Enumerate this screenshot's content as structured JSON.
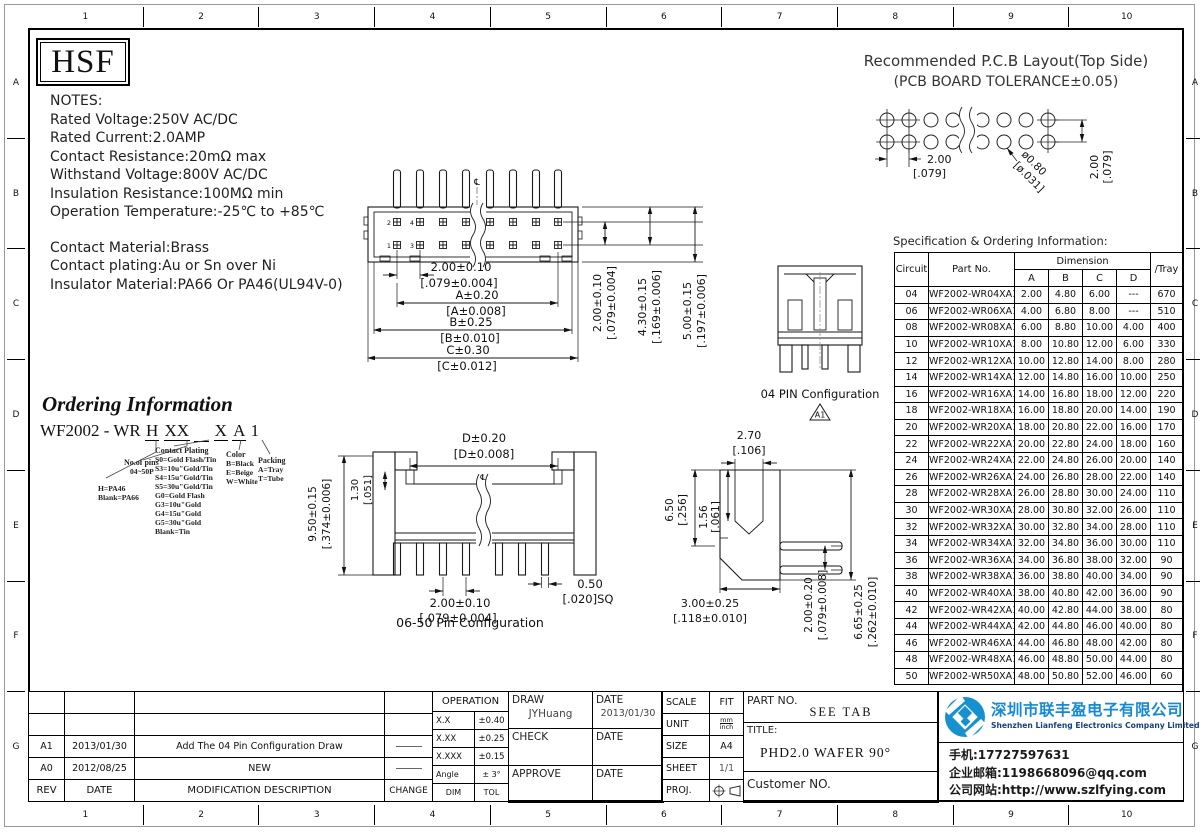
{
  "zones": {
    "cols": [
      "1",
      "2",
      "3",
      "4",
      "5",
      "6",
      "7",
      "8",
      "9",
      "10"
    ],
    "rows": [
      "A",
      "B",
      "C",
      "D",
      "E",
      "F",
      "G"
    ]
  },
  "logo_text": "HSF",
  "notes": {
    "title": "NOTES:",
    "lines": [
      "Rated Voltage:250V AC/DC",
      "Rated Current:2.0AMP",
      "Contact Resistance:20mΩ max",
      "Withstand Voltage:800V AC/DC",
      "Insulation Resistance:100MΩ min",
      "Operation Temperature:-25℃ to +85℃"
    ],
    "material": [
      "Contact Material:Brass",
      "Contact plating:Au or Sn over Ni",
      "Insulator Material:PA66 Or PA46(UL94V-0)"
    ]
  },
  "pcb": {
    "title1": "Recommended P.C.B Layout(Top Side)",
    "title2": "(PCB BOARD TOLERANCE±0.05)",
    "pitch_m": "2.00",
    "pitch_i": "[.079]",
    "hole_m": "ø0.80",
    "hole_i": "[ø.031]",
    "row_m": "2.00",
    "row_i": "[.079]"
  },
  "spec": {
    "caption": "Specification & Ordering Information:",
    "h_circuit": "Circuit",
    "h_part": "Part No.",
    "h_dim": "Dimension",
    "h_cols": [
      "A",
      "B",
      "C",
      "D"
    ],
    "h_tray": "/Tray",
    "rows": [
      [
        "04",
        "WF2002-WR04XA1",
        "2.00",
        "4.80",
        "6.00",
        "---",
        "670"
      ],
      [
        "06",
        "WF2002-WR06XA1",
        "4.00",
        "6.80",
        "8.00",
        "---",
        "510"
      ],
      [
        "08",
        "WF2002-WR08XA1",
        "6.00",
        "8.80",
        "10.00",
        "4.00",
        "400"
      ],
      [
        "10",
        "WF2002-WR10XA1",
        "8.00",
        "10.80",
        "12.00",
        "6.00",
        "330"
      ],
      [
        "12",
        "WF2002-WR12XA1",
        "10.00",
        "12.80",
        "14.00",
        "8.00",
        "280"
      ],
      [
        "14",
        "WF2002-WR14XA1",
        "12.00",
        "14.80",
        "16.00",
        "10.00",
        "250"
      ],
      [
        "16",
        "WF2002-WR16XA1",
        "14.00",
        "16.80",
        "18.00",
        "12.00",
        "220"
      ],
      [
        "18",
        "WF2002-WR18XA1",
        "16.00",
        "18.80",
        "20.00",
        "14.00",
        "190"
      ],
      [
        "20",
        "WF2002-WR20XA1",
        "18.00",
        "20.80",
        "22.00",
        "16.00",
        "170"
      ],
      [
        "22",
        "WF2002-WR22XA1",
        "20.00",
        "22.80",
        "24.00",
        "18.00",
        "160"
      ],
      [
        "24",
        "WF2002-WR24XA1",
        "22.00",
        "24.80",
        "26.00",
        "20.00",
        "140"
      ],
      [
        "26",
        "WF2002-WR26XA1",
        "24.00",
        "26.80",
        "28.00",
        "22.00",
        "140"
      ],
      [
        "28",
        "WF2002-WR28XA1",
        "26.00",
        "28.80",
        "30.00",
        "24.00",
        "110"
      ],
      [
        "30",
        "WF2002-WR30XA1",
        "28.00",
        "30.80",
        "32.00",
        "26.00",
        "110"
      ],
      [
        "32",
        "WF2002-WR32XA1",
        "30.00",
        "32.80",
        "34.00",
        "28.00",
        "110"
      ],
      [
        "34",
        "WF2002-WR34XA1",
        "32.00",
        "34.80",
        "36.00",
        "30.00",
        "110"
      ],
      [
        "36",
        "WF2002-WR36XA1",
        "34.00",
        "36.80",
        "38.00",
        "32.00",
        "90"
      ],
      [
        "38",
        "WF2002-WR38XA1",
        "36.00",
        "38.80",
        "40.00",
        "34.00",
        "90"
      ],
      [
        "40",
        "WF2002-WR40XA1",
        "38.00",
        "40.80",
        "42.00",
        "36.00",
        "90"
      ],
      [
        "42",
        "WF2002-WR42XA1",
        "40.00",
        "42.80",
        "44.00",
        "38.00",
        "80"
      ],
      [
        "44",
        "WF2002-WR44XA1",
        "42.00",
        "44.80",
        "46.00",
        "40.00",
        "80"
      ],
      [
        "46",
        "WF2002-WR46XA1",
        "44.00",
        "46.80",
        "48.00",
        "42.00",
        "80"
      ],
      [
        "48",
        "WF2002-WR48XA1",
        "46.00",
        "48.80",
        "50.00",
        "44.00",
        "80"
      ],
      [
        "50",
        "WF2002-WR50XA1",
        "48.00",
        "50.80",
        "52.00",
        "46.00",
        "60"
      ]
    ]
  },
  "front": {
    "labels": {
      "p2": "2",
      "p4": "4",
      "p1": "1",
      "p3": "3"
    },
    "cl": "℄",
    "chains": [
      {
        "m": "2.00±0.10",
        "i": "[.079±0.004]"
      },
      {
        "m": "A±0.20",
        "i": "[A±0.008]"
      },
      {
        "m": "B±0.25",
        "i": "[B±0.010]"
      },
      {
        "m": "C±0.30",
        "i": "[C±0.012]"
      }
    ],
    "vdims": [
      {
        "m": "2.00±0.10",
        "i": "[.079±0.004]"
      },
      {
        "m": "4.30±0.15",
        "i": "[.169±0.006]"
      },
      {
        "m": "5.00±0.15",
        "i": "[.197±0.006]"
      }
    ]
  },
  "pin04": {
    "label": "04 PIN Configuration",
    "flag": "A1"
  },
  "cfg06": {
    "label": "06-50 Pin Configuration",
    "cl": "℄",
    "d_m": "D±0.20",
    "d_i": "[D±0.008]",
    "h_m": "9.50±0.15",
    "h_i": "[.374±0.006]",
    "s_m": "1.30",
    "s_i": "[.051]",
    "p_m": "2.00±0.10",
    "p_i": "[.079±0.004]",
    "sq_m": "0.50",
    "sq_i": "[.020]SQ"
  },
  "sideview": {
    "w_m": "2.70",
    "w_i": "[.106]",
    "h_m": "6.50",
    "h_i": "[.256]",
    "n_m": "1.56",
    "n_i": "[.061]",
    "d_m": "3.00±0.25",
    "d_i": "[.118±0.010]",
    "pp_m": "2.00±0.20",
    "pp_i": "[.079±0.008]",
    "oh_m": "6.65±0.25",
    "oh_i": "[.262±0.010]"
  },
  "ordering": {
    "title": "Ordering Information",
    "code_prefix": "WF2002 - WR",
    "code_h": "H",
    "code_xx": "XX",
    "code_x": "X",
    "code_a": "A",
    "code_1": "1",
    "material": [
      "H=PA46",
      "Blank=PA66"
    ],
    "pins_title": "No.of pins",
    "pins_range": "04~50P",
    "plating_title": "Contact Plating",
    "plating": [
      "S0=Gold Flash/Tin",
      "S3=10u\"Gold/Tin",
      "S4=15u\"Gold/Tin",
      "S5=30u\"Gold/Tin",
      "G0=Gold Flash",
      "G3=10u\"Gold",
      "G4=15u\"Gold",
      "G5=30u\"Gold",
      "Blank=Tin"
    ],
    "color_title": "Color",
    "colors": [
      "B=Black",
      "E=Beige",
      "W=White"
    ],
    "packing_title": "Packing",
    "packing": [
      "A=Tray",
      "T=Tube"
    ]
  },
  "rev": {
    "headers": [
      "REV",
      "DATE",
      "MODIFICATION  DESCRIPTION",
      "CHANGE"
    ],
    "rows": [
      {
        "rev": "A1",
        "date": "2013/01/30",
        "desc": "Add The 04 Pin Configuration Draw"
      },
      {
        "rev": "A0",
        "date": "2012/08/25",
        "desc": "NEW"
      }
    ]
  },
  "oper": {
    "title": "OPERATION",
    "rows": [
      [
        "X.X",
        "±0.40"
      ],
      [
        "X.XX",
        "±0.25"
      ],
      [
        "X.XXX",
        "±0.15"
      ],
      [
        "Angle",
        "± 3°"
      ],
      [
        "DIM",
        "TOL"
      ]
    ]
  },
  "sign": {
    "draw": "DRAW",
    "draw_name": "JYHuang",
    "date": "DATE",
    "draw_date": "2013/01/30",
    "check": "CHECK",
    "approve": "APPROVE"
  },
  "meta": {
    "scale": "SCALE",
    "scale_v": "FIT",
    "unit": "UNIT",
    "unit_top": "mm",
    "unit_bot": "inch",
    "size": "SIZE",
    "size_v": "A4",
    "sheet": "SHEET",
    "sheet_v": "1/1",
    "proj": "PROJ."
  },
  "partblk": {
    "part_label": "PART NO.",
    "part_v": "SEE TAB",
    "title_label": "TITLE:",
    "title_v": "PHD2.0 WAFER 90°",
    "customer": "Customer NO."
  },
  "company": {
    "cn": "深圳市联丰盈电子有限公司",
    "en": "Shenzhen Lianfeng Electronics Company Limited",
    "phone": "手机:17727597631",
    "email": "企业邮箱:1198668096@qq.com",
    "web": "公司网站:http://www.szlfying.com",
    "brand_blue": "#1489d8"
  }
}
